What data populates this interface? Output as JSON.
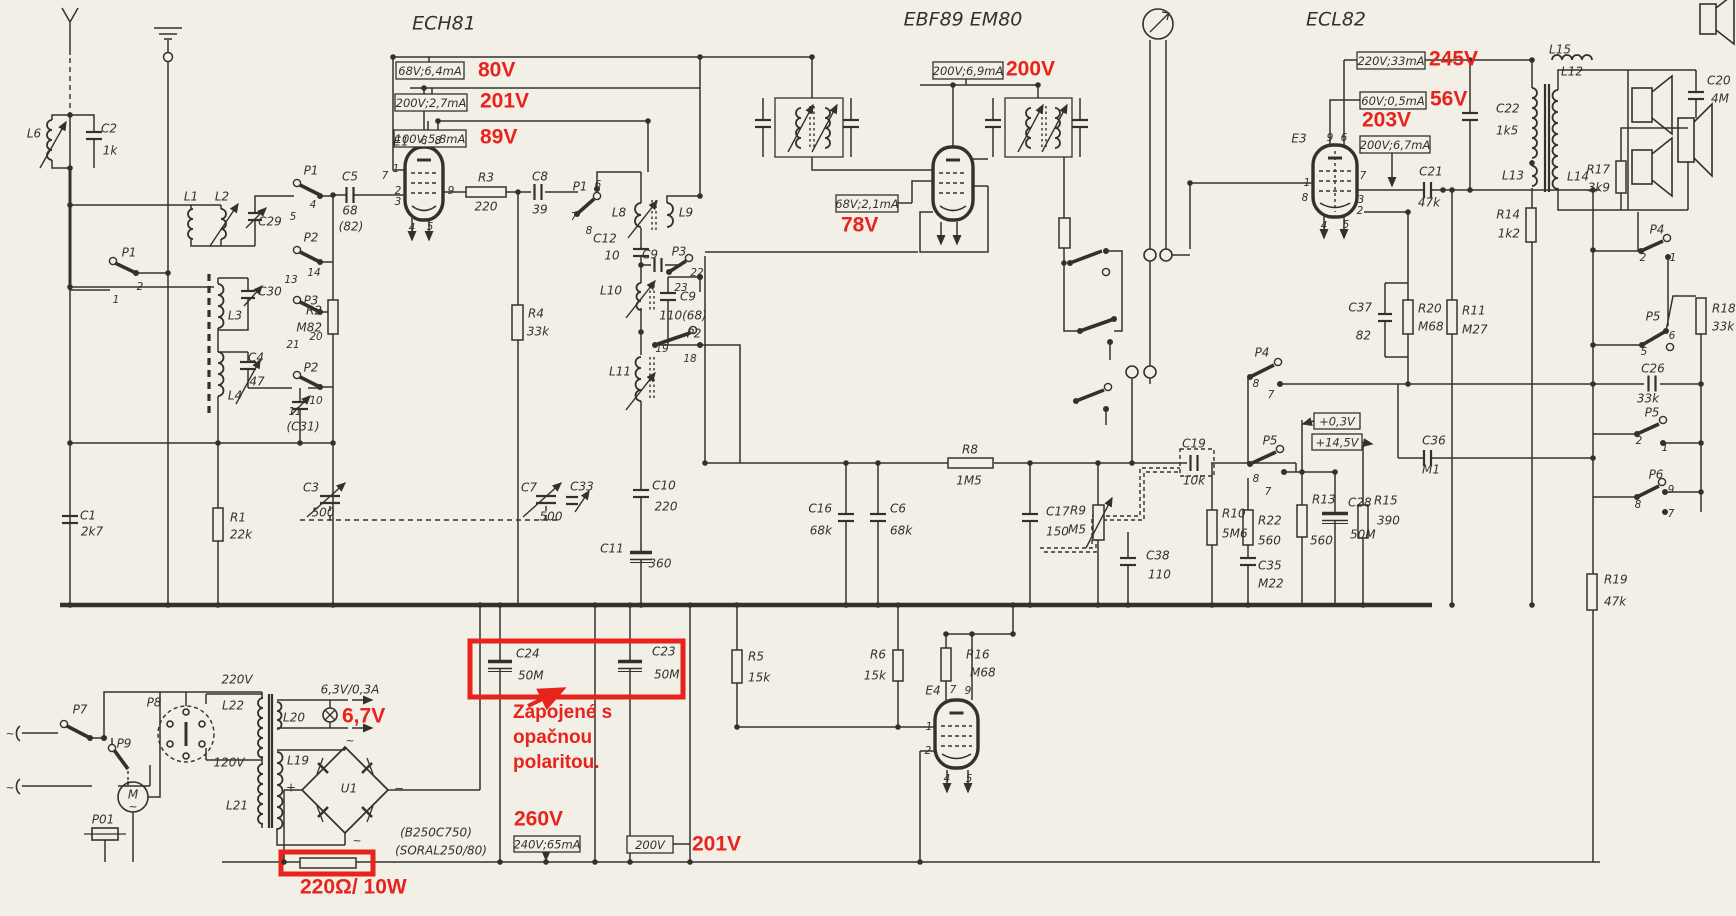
{
  "colors": {
    "paper": "#f2efe7",
    "ink": "#34312b",
    "red": "#e8231c"
  },
  "diagram": {
    "tubes": [
      {
        "t": "ECH81",
        "x": 444,
        "y": 24
      },
      {
        "t": "EBF89 EM80",
        "x": 963,
        "y": 20
      },
      {
        "t": "ECL82",
        "x": 1336,
        "y": 20
      }
    ],
    "callouts": [
      {
        "box": {
          "t": "68V;6,4mA",
          "x": 396,
          "y": 62,
          "w": 68,
          "h": 17
        },
        "red": {
          "t": "80V",
          "x": 478,
          "y": 71
        }
      },
      {
        "box": {
          "t": "200V;2,7mA",
          "x": 395,
          "y": 94,
          "w": 72,
          "h": 17
        },
        "red": {
          "t": "201V",
          "x": 480,
          "y": 102
        }
      },
      {
        "box": {
          "t": "100V;5,8mA",
          "x": 394,
          "y": 130,
          "w": 72,
          "h": 17
        },
        "red": {
          "t": "89V",
          "x": 480,
          "y": 138
        }
      },
      {
        "box": {
          "t": "200V;6,9mA",
          "x": 933,
          "y": 62,
          "w": 70,
          "h": 17
        },
        "red": {
          "t": "200V",
          "x": 1006,
          "y": 70
        }
      },
      {
        "box": {
          "t": "68V;2,1mA",
          "x": 836,
          "y": 195,
          "w": 62,
          "h": 17
        },
        "red": {
          "t": "78V",
          "x": 841,
          "y": 226
        }
      },
      {
        "box": {
          "t": "220V;33mA",
          "x": 1357,
          "y": 52,
          "w": 68,
          "h": 17
        },
        "red": {
          "t": "245V",
          "x": 1429,
          "y": 60
        }
      },
      {
        "box": {
          "t": "60V;0,5mA",
          "x": 1360,
          "y": 92,
          "w": 66,
          "h": 17
        },
        "red": {
          "t": "56V",
          "x": 1430,
          "y": 100
        }
      },
      {
        "box": {
          "t": "200V;6,7mA",
          "x": 1360,
          "y": 136,
          "w": 70,
          "h": 17
        },
        "red": {
          "t": "203V",
          "x": 1362,
          "y": 121
        }
      },
      {
        "box": {
          "t": "+0,3V",
          "x": 1314,
          "y": 413,
          "w": 46,
          "h": 16
        }
      },
      {
        "box": {
          "t": "+14,5V",
          "x": 1312,
          "y": 434,
          "w": 50,
          "h": 16
        }
      },
      {
        "box": {
          "t": "240V;65mA",
          "x": 514,
          "y": 836,
          "w": 66,
          "h": 16
        },
        "red": {
          "t": "260V",
          "x": 514,
          "y": 820
        }
      },
      {
        "box": {
          "t": "200V",
          "x": 627,
          "y": 836,
          "w": 46,
          "h": 17
        },
        "red": {
          "t": "201V",
          "x": 692,
          "y": 845
        }
      },
      {
        "red": {
          "t": "6,7V",
          "x": 342,
          "y": 717
        }
      },
      {
        "red": {
          "t": "220Ω/ 10W",
          "x": 300,
          "y": 888
        }
      }
    ],
    "note": {
      "lines": [
        "Zapojené s",
        "opačnou",
        "polaritou."
      ],
      "x": 513,
      "y": [
        713,
        738,
        763
      ]
    },
    "parts": [
      {
        "t": "L6",
        "x": 34,
        "y": 134
      },
      {
        "t": "C2",
        "x": 109,
        "y": 129
      },
      {
        "t": "1k",
        "x": 110,
        "y": 151
      },
      {
        "t": "L1",
        "x": 191,
        "y": 197
      },
      {
        "t": "L2",
        "x": 222,
        "y": 197
      },
      {
        "t": "C29",
        "x": 270,
        "y": 222
      },
      {
        "t": "P1",
        "x": 311,
        "y": 171
      },
      {
        "t": "4",
        "x": 313,
        "y": 205,
        "c": "n"
      },
      {
        "t": "5",
        "x": 293,
        "y": 217,
        "c": "n"
      },
      {
        "t": "P2",
        "x": 311,
        "y": 238
      },
      {
        "t": "14",
        "x": 314,
        "y": 273,
        "c": "n"
      },
      {
        "t": "13",
        "x": 291,
        "y": 280,
        "c": "n"
      },
      {
        "t": "P3",
        "x": 311,
        "y": 301
      },
      {
        "t": "20",
        "x": 316,
        "y": 337,
        "c": "n"
      },
      {
        "t": "21",
        "x": 293,
        "y": 345,
        "c": "n"
      },
      {
        "t": "P2",
        "x": 311,
        "y": 368
      },
      {
        "t": "10",
        "x": 316,
        "y": 401,
        "c": "n"
      },
      {
        "t": "11",
        "x": 295,
        "y": 412,
        "c": "n"
      },
      {
        "t": "(C31)",
        "x": 303,
        "y": 427
      },
      {
        "t": "P1",
        "x": 129,
        "y": 253
      },
      {
        "t": "2",
        "x": 140,
        "y": 287,
        "c": "n"
      },
      {
        "t": "1",
        "x": 116,
        "y": 300,
        "c": "n"
      },
      {
        "t": "C30",
        "x": 270,
        "y": 292
      },
      {
        "t": "L3",
        "x": 235,
        "y": 316
      },
      {
        "t": "C4",
        "x": 256,
        "y": 358
      },
      {
        "t": "47",
        "x": 257,
        "y": 382
      },
      {
        "t": "L4",
        "x": 235,
        "y": 396
      },
      {
        "t": "C1",
        "x": 88,
        "y": 516
      },
      {
        "t": "2k7",
        "x": 92,
        "y": 532
      },
      {
        "t": "R1",
        "x": 238,
        "y": 518
      },
      {
        "t": "22k",
        "x": 241,
        "y": 535
      },
      {
        "t": "C5",
        "x": 350,
        "y": 177
      },
      {
        "t": "68",
        "x": 350,
        "y": 211
      },
      {
        "t": "(82)",
        "x": 351,
        "y": 227
      },
      {
        "t": "R2",
        "x": 322,
        "y": 311,
        "a": "e"
      },
      {
        "t": "M82",
        "x": 322,
        "y": 328,
        "a": "e"
      },
      {
        "t": "E1",
        "x": 401,
        "y": 142
      },
      {
        "t": "6",
        "x": 424,
        "y": 141,
        "c": "n"
      },
      {
        "t": "8",
        "x": 438,
        "y": 141,
        "c": "n"
      },
      {
        "t": "1",
        "x": 396,
        "y": 169,
        "c": "n"
      },
      {
        "t": "7",
        "x": 385,
        "y": 176,
        "c": "n"
      },
      {
        "t": "2",
        "x": 398,
        "y": 191,
        "c": "n"
      },
      {
        "t": "3",
        "x": 398,
        "y": 202,
        "c": "n"
      },
      {
        "t": "9",
        "x": 451,
        "y": 191,
        "c": "n"
      },
      {
        "t": "4",
        "x": 412,
        "y": 228,
        "c": "n"
      },
      {
        "t": "5",
        "x": 430,
        "y": 227,
        "c": "n"
      },
      {
        "t": "R3",
        "x": 486,
        "y": 178
      },
      {
        "t": "220",
        "x": 486,
        "y": 207
      },
      {
        "t": "C8",
        "x": 540,
        "y": 177
      },
      {
        "t": "39",
        "x": 540,
        "y": 210
      },
      {
        "t": "P1",
        "x": 580,
        "y": 187
      },
      {
        "t": "6",
        "x": 598,
        "y": 185,
        "c": "n"
      },
      {
        "t": "7",
        "x": 574,
        "y": 217,
        "c": "n"
      },
      {
        "t": "8",
        "x": 589,
        "y": 231,
        "c": "n"
      },
      {
        "t": "L8",
        "x": 619,
        "y": 213
      },
      {
        "t": "L9",
        "x": 686,
        "y": 213
      },
      {
        "t": "C12",
        "x": 605,
        "y": 239
      },
      {
        "t": "10",
        "x": 612,
        "y": 256
      },
      {
        "t": "C9",
        "x": 650,
        "y": 255
      },
      {
        "t": "P3",
        "x": 679,
        "y": 252
      },
      {
        "t": "22",
        "x": 697,
        "y": 273,
        "c": "n"
      },
      {
        "t": "23",
        "x": 681,
        "y": 288,
        "c": "n"
      },
      {
        "t": "L10",
        "x": 611,
        "y": 291
      },
      {
        "t": "C9",
        "x": 688,
        "y": 297
      },
      {
        "t": "110(68)",
        "x": 683,
        "y": 316
      },
      {
        "t": "19",
        "x": 662,
        "y": 349,
        "c": "n"
      },
      {
        "t": "P2",
        "x": 694,
        "y": 334
      },
      {
        "t": "18",
        "x": 690,
        "y": 359,
        "c": "n"
      },
      {
        "t": "L11",
        "x": 620,
        "y": 372
      },
      {
        "t": "R4",
        "x": 536,
        "y": 314
      },
      {
        "t": "33k",
        "x": 538,
        "y": 332
      },
      {
        "t": "C3",
        "x": 311,
        "y": 488
      },
      {
        "t": "500",
        "x": 323,
        "y": 513
      },
      {
        "t": "C7",
        "x": 529,
        "y": 488
      },
      {
        "t": "C33",
        "x": 582,
        "y": 487
      },
      {
        "t": "500",
        "x": 551,
        "y": 517
      },
      {
        "t": "C10",
        "x": 664,
        "y": 486
      },
      {
        "t": "220",
        "x": 666,
        "y": 507
      },
      {
        "t": "C11",
        "x": 612,
        "y": 549
      },
      {
        "t": "360",
        "x": 660,
        "y": 564
      },
      {
        "t": "C16",
        "x": 832,
        "y": 509,
        "a": "e"
      },
      {
        "t": "68k",
        "x": 832,
        "y": 531,
        "a": "e"
      },
      {
        "t": "C6",
        "x": 890,
        "y": 509,
        "a": "s"
      },
      {
        "t": "68k",
        "x": 890,
        "y": 531,
        "a": "s"
      },
      {
        "t": "R8",
        "x": 970,
        "y": 450
      },
      {
        "t": "1M5",
        "x": 969,
        "y": 481
      },
      {
        "t": "C17",
        "x": 1046,
        "y": 512,
        "a": "s"
      },
      {
        "t": "150",
        "x": 1046,
        "y": 532,
        "a": "s"
      },
      {
        "t": "R9",
        "x": 1086,
        "y": 511,
        "a": "e"
      },
      {
        "t": "M5",
        "x": 1086,
        "y": 530,
        "a": "e"
      },
      {
        "t": "C38",
        "x": 1146,
        "y": 556,
        "a": "s"
      },
      {
        "t": "110",
        "x": 1148,
        "y": 575,
        "a": "s"
      },
      {
        "t": "C19",
        "x": 1194,
        "y": 444
      },
      {
        "t": "10k",
        "x": 1194,
        "y": 481
      },
      {
        "t": "R10",
        "x": 1222,
        "y": 514,
        "a": "s"
      },
      {
        "t": "5M6",
        "x": 1222,
        "y": 534,
        "a": "s"
      },
      {
        "t": "R22",
        "x": 1258,
        "y": 521,
        "a": "s"
      },
      {
        "t": "560",
        "x": 1258,
        "y": 541,
        "a": "s"
      },
      {
        "t": "C35",
        "x": 1258,
        "y": 566,
        "a": "s"
      },
      {
        "t": "M22",
        "x": 1258,
        "y": 584,
        "a": "s"
      },
      {
        "t": "P4",
        "x": 1262,
        "y": 353
      },
      {
        "t": "8",
        "x": 1256,
        "y": 384,
        "c": "n"
      },
      {
        "t": "7",
        "x": 1271,
        "y": 395,
        "c": "n"
      },
      {
        "t": "P5",
        "x": 1270,
        "y": 441
      },
      {
        "t": "8",
        "x": 1256,
        "y": 479,
        "c": "n"
      },
      {
        "t": "7",
        "x": 1268,
        "y": 492,
        "c": "n"
      },
      {
        "t": "R13",
        "x": 1312,
        "y": 500,
        "a": "s"
      },
      {
        "t": "560",
        "x": 1310,
        "y": 541,
        "a": "s"
      },
      {
        "t": "C28",
        "x": 1348,
        "y": 503,
        "a": "s"
      },
      {
        "t": "50M",
        "x": 1350,
        "y": 535,
        "a": "s"
      },
      {
        "t": "R15",
        "x": 1374,
        "y": 501,
        "a": "s"
      },
      {
        "t": "390",
        "x": 1377,
        "y": 521,
        "a": "s"
      },
      {
        "t": "C36",
        "x": 1434,
        "y": 441
      },
      {
        "t": "M1",
        "x": 1431,
        "y": 470
      },
      {
        "t": "C37",
        "x": 1372,
        "y": 308,
        "a": "e"
      },
      {
        "t": "82",
        "x": 1371,
        "y": 336,
        "a": "e"
      },
      {
        "t": "R20",
        "x": 1418,
        "y": 309,
        "a": "s"
      },
      {
        "t": "M68",
        "x": 1418,
        "y": 327,
        "a": "s"
      },
      {
        "t": "R11",
        "x": 1462,
        "y": 311,
        "a": "s"
      },
      {
        "t": "M27",
        "x": 1462,
        "y": 330,
        "a": "s"
      },
      {
        "t": "E3",
        "x": 1299,
        "y": 139
      },
      {
        "t": "9",
        "x": 1330,
        "y": 138,
        "c": "n"
      },
      {
        "t": "6",
        "x": 1344,
        "y": 138,
        "c": "n"
      },
      {
        "t": "1",
        "x": 1307,
        "y": 183,
        "c": "n"
      },
      {
        "t": "7",
        "x": 1363,
        "y": 176,
        "c": "n"
      },
      {
        "t": "8",
        "x": 1305,
        "y": 198,
        "c": "n"
      },
      {
        "t": "3",
        "x": 1361,
        "y": 200,
        "c": "n"
      },
      {
        "t": "2",
        "x": 1360,
        "y": 211,
        "c": "n"
      },
      {
        "t": "4",
        "x": 1324,
        "y": 226,
        "c": "n"
      },
      {
        "t": "5",
        "x": 1346,
        "y": 225,
        "c": "n"
      },
      {
        "t": "C21",
        "x": 1431,
        "y": 172
      },
      {
        "t": "47k",
        "x": 1429,
        "y": 203
      },
      {
        "t": "C22",
        "x": 1496,
        "y": 109,
        "a": "s"
      },
      {
        "t": "1k5",
        "x": 1496,
        "y": 131,
        "a": "s"
      },
      {
        "t": "L12",
        "x": 1572,
        "y": 72
      },
      {
        "t": "L13",
        "x": 1513,
        "y": 176
      },
      {
        "t": "L14",
        "x": 1578,
        "y": 177
      },
      {
        "t": "R14",
        "x": 1520,
        "y": 215,
        "a": "e"
      },
      {
        "t": "1k2",
        "x": 1520,
        "y": 234,
        "a": "e"
      },
      {
        "t": "L15",
        "x": 1560,
        "y": 50
      },
      {
        "t": "R17",
        "x": 1610,
        "y": 170,
        "a": "e"
      },
      {
        "t": "3k9",
        "x": 1610,
        "y": 188,
        "a": "e"
      },
      {
        "t": "C20",
        "x": 1707,
        "y": 81,
        "a": "s"
      },
      {
        "t": "4M",
        "x": 1711,
        "y": 99,
        "a": "s"
      },
      {
        "t": "P4",
        "x": 1657,
        "y": 230
      },
      {
        "t": "2",
        "x": 1643,
        "y": 258,
        "c": "n"
      },
      {
        "t": "1",
        "x": 1673,
        "y": 258,
        "c": "n"
      },
      {
        "t": "P5",
        "x": 1653,
        "y": 317
      },
      {
        "t": "6",
        "x": 1672,
        "y": 336,
        "c": "n"
      },
      {
        "t": "5",
        "x": 1644,
        "y": 352,
        "c": "n"
      },
      {
        "t": "R18",
        "x": 1712,
        "y": 309,
        "a": "s"
      },
      {
        "t": "33k",
        "x": 1712,
        "y": 327,
        "a": "s"
      },
      {
        "t": "C26",
        "x": 1653,
        "y": 369
      },
      {
        "t": "33k",
        "x": 1648,
        "y": 399
      },
      {
        "t": "P5",
        "x": 1652,
        "y": 413
      },
      {
        "t": "2",
        "x": 1639,
        "y": 441,
        "c": "n"
      },
      {
        "t": "1",
        "x": 1665,
        "y": 448,
        "c": "n"
      },
      {
        "t": "P6",
        "x": 1656,
        "y": 475
      },
      {
        "t": "9",
        "x": 1671,
        "y": 490,
        "c": "n"
      },
      {
        "t": "8",
        "x": 1638,
        "y": 505,
        "c": "n"
      },
      {
        "t": "7",
        "x": 1671,
        "y": 514,
        "c": "n"
      },
      {
        "t": "R19",
        "x": 1604,
        "y": 580,
        "a": "s"
      },
      {
        "t": "47k",
        "x": 1604,
        "y": 602,
        "a": "s"
      },
      {
        "t": "R5",
        "x": 748,
        "y": 657,
        "a": "s"
      },
      {
        "t": "15k",
        "x": 748,
        "y": 678,
        "a": "s"
      },
      {
        "t": "R6",
        "x": 886,
        "y": 655,
        "a": "e"
      },
      {
        "t": "15k",
        "x": 886,
        "y": 676,
        "a": "e"
      },
      {
        "t": "R16",
        "x": 966,
        "y": 655,
        "a": "s"
      },
      {
        "t": "M68",
        "x": 970,
        "y": 673,
        "a": "s"
      },
      {
        "t": "E4",
        "x": 933,
        "y": 691
      },
      {
        "t": "7",
        "x": 953,
        "y": 690,
        "c": "n"
      },
      {
        "t": "9",
        "x": 968,
        "y": 691,
        "c": "n"
      },
      {
        "t": "1",
        "x": 929,
        "y": 727,
        "c": "n"
      },
      {
        "t": "2",
        "x": 928,
        "y": 751,
        "c": "n"
      },
      {
        "t": "4",
        "x": 947,
        "y": 779,
        "c": "n"
      },
      {
        "t": "5",
        "x": 969,
        "y": 779,
        "c": "n"
      },
      {
        "t": "C24",
        "x": 516,
        "y": 654,
        "a": "s"
      },
      {
        "t": "50M",
        "x": 518,
        "y": 676,
        "a": "s"
      },
      {
        "t": "C23",
        "x": 652,
        "y": 652,
        "a": "s"
      },
      {
        "t": "50M",
        "x": 654,
        "y": 675,
        "a": "s"
      },
      {
        "t": "P7",
        "x": 80,
        "y": 710
      },
      {
        "t": "P8",
        "x": 154,
        "y": 703
      },
      {
        "t": "P9",
        "x": 124,
        "y": 744
      },
      {
        "t": "P01",
        "x": 103,
        "y": 820
      },
      {
        "t": "M",
        "x": 133,
        "y": 795
      },
      {
        "t": "~",
        "x": 133,
        "y": 807,
        "c": "n"
      },
      {
        "t": "220V",
        "x": 237,
        "y": 680
      },
      {
        "t": "120V",
        "x": 229,
        "y": 763
      },
      {
        "t": "L22",
        "x": 233,
        "y": 706
      },
      {
        "t": "L21",
        "x": 237,
        "y": 806
      },
      {
        "t": "L20",
        "x": 294,
        "y": 718
      },
      {
        "t": "L19",
        "x": 298,
        "y": 761
      },
      {
        "t": "6,3V/0,3A",
        "x": 350,
        "y": 690
      },
      {
        "t": "U1",
        "x": 349,
        "y": 789
      },
      {
        "t": "+",
        "x": 291,
        "y": 788
      },
      {
        "t": "−",
        "x": 399,
        "y": 789
      },
      {
        "t": "~",
        "x": 350,
        "y": 741,
        "c": "n"
      },
      {
        "t": "~",
        "x": 357,
        "y": 841,
        "c": "n"
      },
      {
        "t": "~",
        "x": 10,
        "y": 734,
        "c": "n"
      },
      {
        "t": "~",
        "x": 10,
        "y": 788,
        "c": "n"
      },
      {
        "t": "(B250C750)",
        "x": 436,
        "y": 833
      },
      {
        "t": "(SORAL250/80)",
        "x": 441,
        "y": 851
      }
    ]
  }
}
